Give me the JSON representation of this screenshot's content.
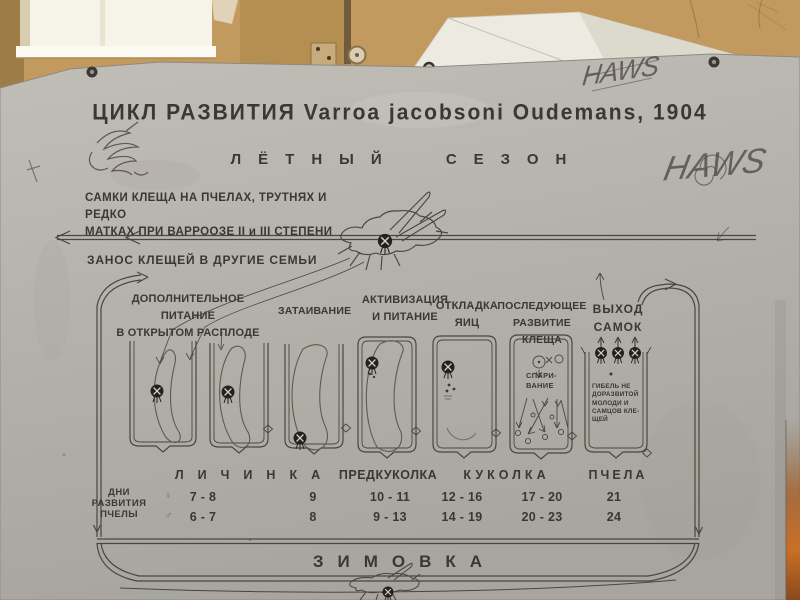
{
  "colors": {
    "wall": "#c29a5f",
    "window": "#f6f3e9",
    "poster_background": "#b7b3ad",
    "ink": "#3b3733",
    "hive_lid": "#eceae1",
    "edge_glow": "#c06a23"
  },
  "icons": {
    "mite_icon": "filled-circle-with-x",
    "female_icon": "♀",
    "male_icon": "♂"
  },
  "poster": {
    "title": "ЦИКЛ РАЗВИТИЯ Varroa jacobsoni Oudemans, 1904",
    "season_heading": "ЛЁТНЫЙ СЕЗОН",
    "intro_lines": [
      "САМКИ КЛЕЩА НА ПЧЕЛАХ, ТРУТНЯХ И РЕДКО",
      "МАТКАХ ПРИ ВАРРООЗЕ II и III СТЕПЕНИ"
    ],
    "transfer_note": "ЗАНОС КЛЕЩЕЙ В ДРУГИЕ СЕМЬИ",
    "flow_labels": [
      {
        "lines": [
          "ДОПОЛНИТЕЛЬНОЕ ПИТАНИЕ",
          "В ОТКРЫТОМ РАСПЛОДЕ"
        ]
      },
      {
        "lines": [
          "ЗАТАИВАНИЕ"
        ]
      },
      {
        "lines": [
          "АКТИВИЗАЦИЯ",
          "И ПИТАНИЕ"
        ]
      },
      {
        "lines": [
          "ОТКЛАДКА",
          "ЯИЦ"
        ]
      },
      {
        "lines": [
          "ПОСЛЕДУЮЩЕЕ",
          "РАЗВИТИЕ КЛЕЩА"
        ]
      },
      {
        "lines": [
          "ВЫХОД",
          "САМОК"
        ]
      }
    ],
    "mating_label_lines": [
      "СПАРИ-",
      "ВАНИЕ"
    ],
    "death_note_lines": [
      "ГИБЕЛЬ НЕ",
      "ДОРАЗВИТОЙ",
      "МОЛОДИ И",
      "САМЦОВ КЛЕ-",
      "ЩЕЙ"
    ],
    "dev_table": {
      "row_header_lines": [
        "ДНИ",
        "РАЗВИТИЯ",
        "ПЧЕЛЫ"
      ],
      "stage_headers": [
        "ЛИЧИНКА",
        "ПРЕДКУКОЛКА",
        "КУКОЛКА",
        "ПЧЕЛА"
      ],
      "rows": [
        {
          "symbol": "♀",
          "values": [
            "7 - 8",
            "9",
            "10 - 11",
            "12 - 16",
            "17 - 20",
            "21"
          ]
        },
        {
          "symbol": "♂",
          "values": [
            "6 - 7",
            "8",
            "9 - 13",
            "14 - 19",
            "20 - 23",
            "24"
          ]
        }
      ]
    },
    "winter_heading": "ЗИМОВКА",
    "graffiti": {
      "tag_top": "HAWS",
      "tag_right": "HAWS"
    }
  }
}
